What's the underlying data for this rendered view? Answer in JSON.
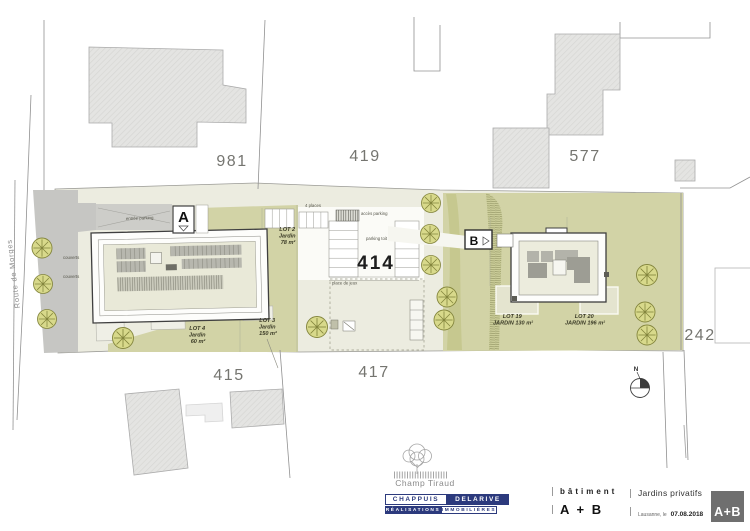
{
  "plan": {
    "road_label": "Route de Morges",
    "compass": "N",
    "parcels": {
      "p981": "981",
      "p419": "419",
      "p577": "577",
      "p414": "414",
      "p415": "415",
      "p417": "417",
      "p242": "242"
    },
    "entrances": {
      "a": "A",
      "b": "B"
    },
    "lots": {
      "lot2": {
        "line1": "LOT 2",
        "line2": "Jardin",
        "line3": "78 m²"
      },
      "lot3": {
        "line1": "LOT 3",
        "line2": "Jardin",
        "line3": "150 m²"
      },
      "lot4": {
        "line1": "LOT 4",
        "line2": "Jardin",
        "line3": "60 m²"
      },
      "lot19": {
        "line1": "LOT 19",
        "line2": "JARDIN 130 m²"
      },
      "lot20": {
        "line1": "LOT 20",
        "line2": "JARDIN 196 m²"
      }
    },
    "annotations": {
      "entree": "entrée parking",
      "acces": "accès parking",
      "places": "4 places",
      "parking_toit": "parking toit",
      "jeux": "place de jeux",
      "couverts1": "couverts",
      "couverts2": "couverts"
    }
  },
  "titleblock": {
    "project": {
      "name": "Champ Tiraud"
    },
    "company": {
      "top_left": "CHAPPUIS",
      "top_right": "DELARIVE",
      "bottom_left": "RÉALISATIONS",
      "bottom_right": "IMMOBILIÈRES"
    },
    "batiment": {
      "label": "bâtiment",
      "value": "A + B"
    },
    "sheet": {
      "title": "Jardins privatifs",
      "place": "Lausanne, le",
      "date": "07.08.2018"
    },
    "badge": "A+B"
  }
}
